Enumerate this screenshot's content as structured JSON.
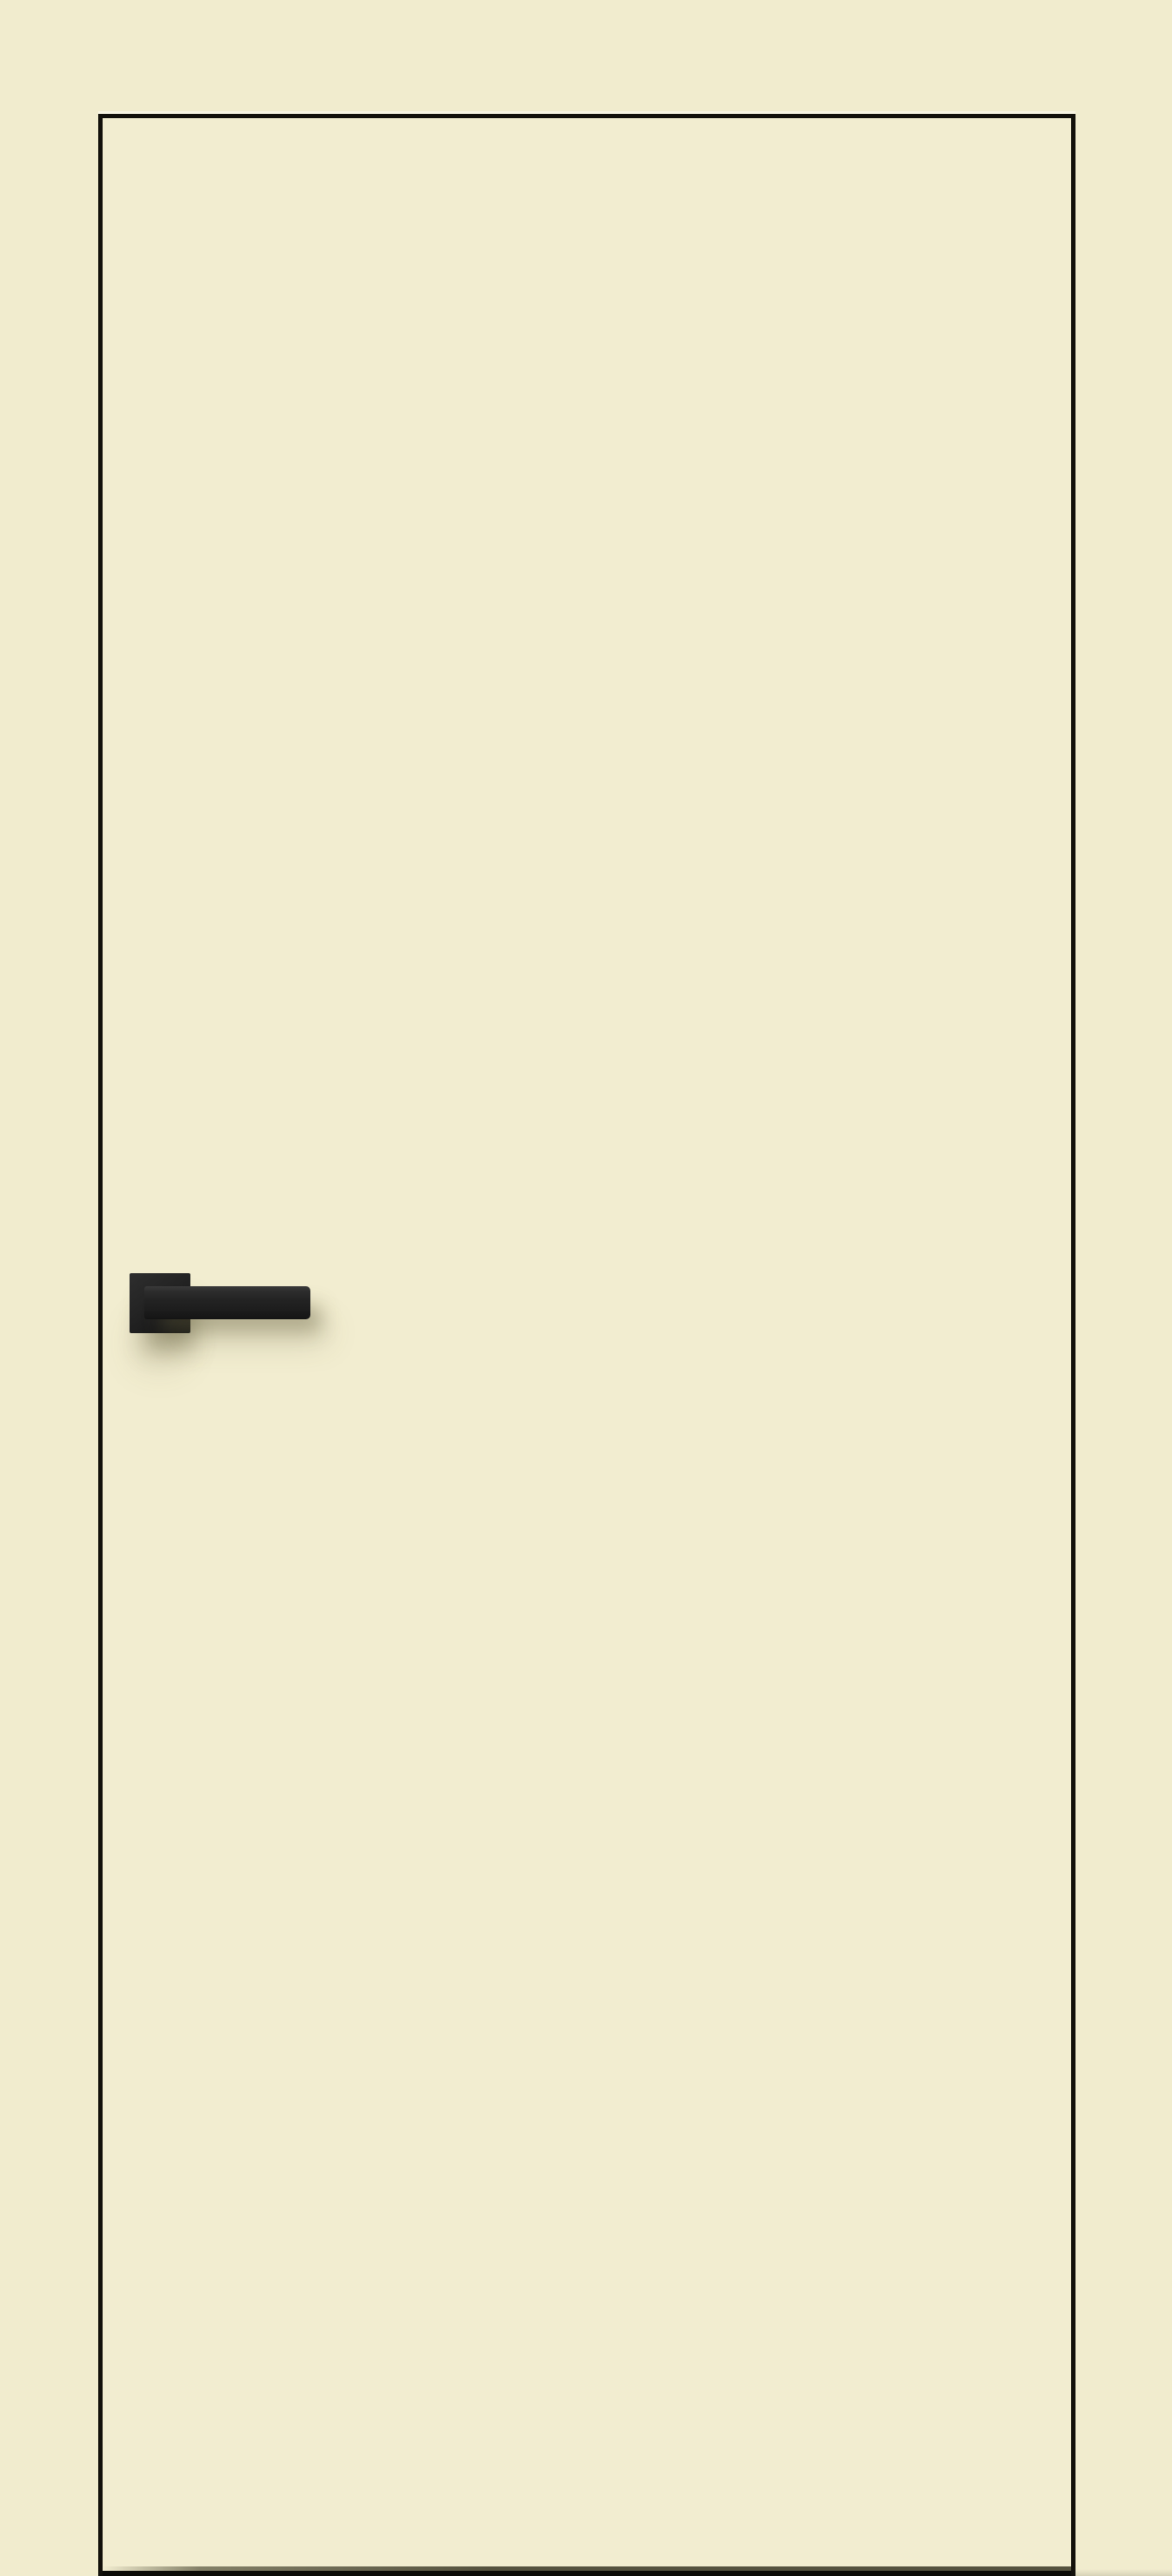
{
  "image": {
    "type": "product-photo",
    "title": "Cream flush interior door with black edge trim and black square-rosette lever handle",
    "subject": "Flush door slab, plain cream finish, thin black edge banding on top and sides, matte-black lever handle on square rosette mounted on the left side, dark gap at floor level"
  },
  "colors": {
    "wall": "#f1ecce",
    "door_face": "#f2edd0",
    "edge_trim": "#13110b",
    "top_highlight": "#fcfaee",
    "handle_dark": "#141414",
    "handle_mid": "#232323",
    "handle_light": "#2e2e2e",
    "threshold": "#55523e",
    "bottom_gap": "#0c0b07",
    "shadow_tint": "rgba(98,92,60,0.42)",
    "floor_shadow": "rgba(140,138,120,0.45)"
  }
}
